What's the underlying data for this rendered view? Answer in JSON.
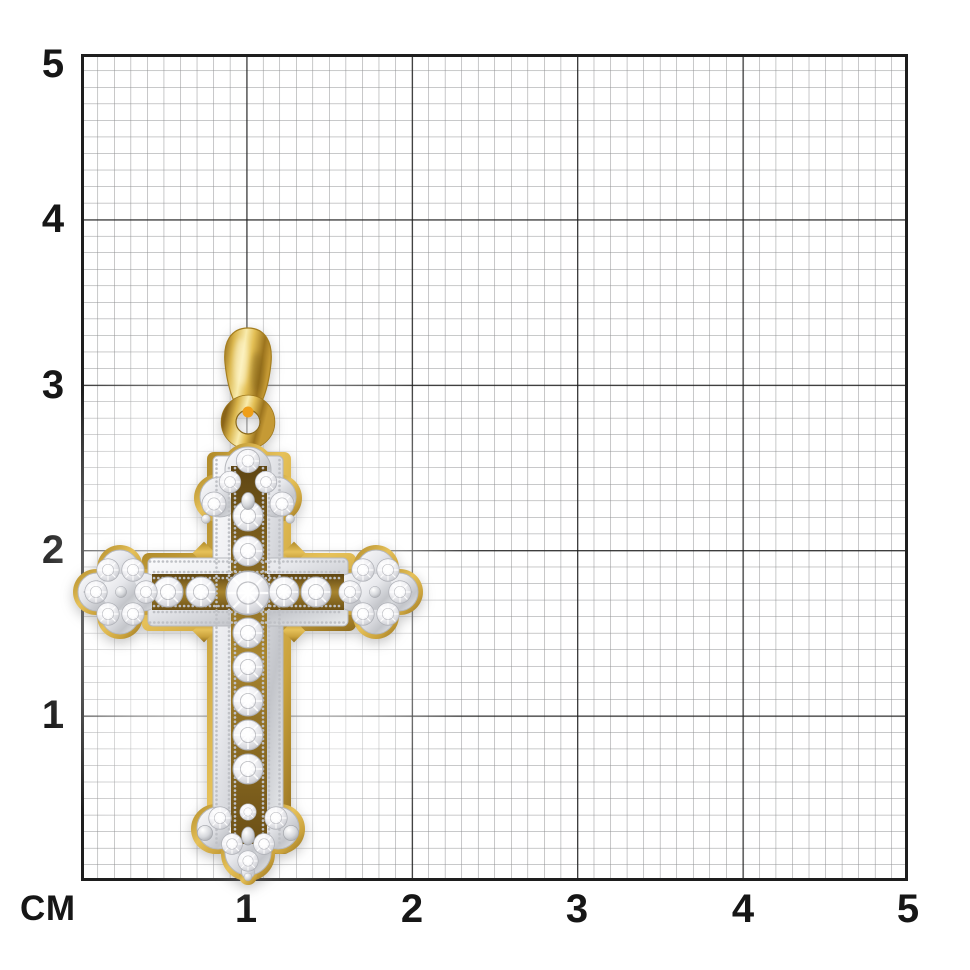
{
  "ruler": {
    "unit_label": "СМ",
    "left_labels": [
      "5",
      "4",
      "3",
      "2",
      "1"
    ],
    "bottom_labels": [
      "1",
      "2",
      "3",
      "4",
      "5"
    ],
    "minor_divisions_per_major": 10,
    "major_step_cm": 1
  },
  "grid": {
    "background_color": "#ffffff",
    "minor_line_color": "#8f9092",
    "major_line_color": "#1e1e1e",
    "label_color": "#161616"
  },
  "pendant": {
    "semantic": "yellow-gold-cross-pendant-with-diamonds",
    "yellow_gold_color": "#e3bf55",
    "white_gold_color": "#e4e5e9",
    "diamond_color": "#f3f3f6",
    "approx_width_cm": 2.0,
    "approx_height_cm": 3.4
  }
}
